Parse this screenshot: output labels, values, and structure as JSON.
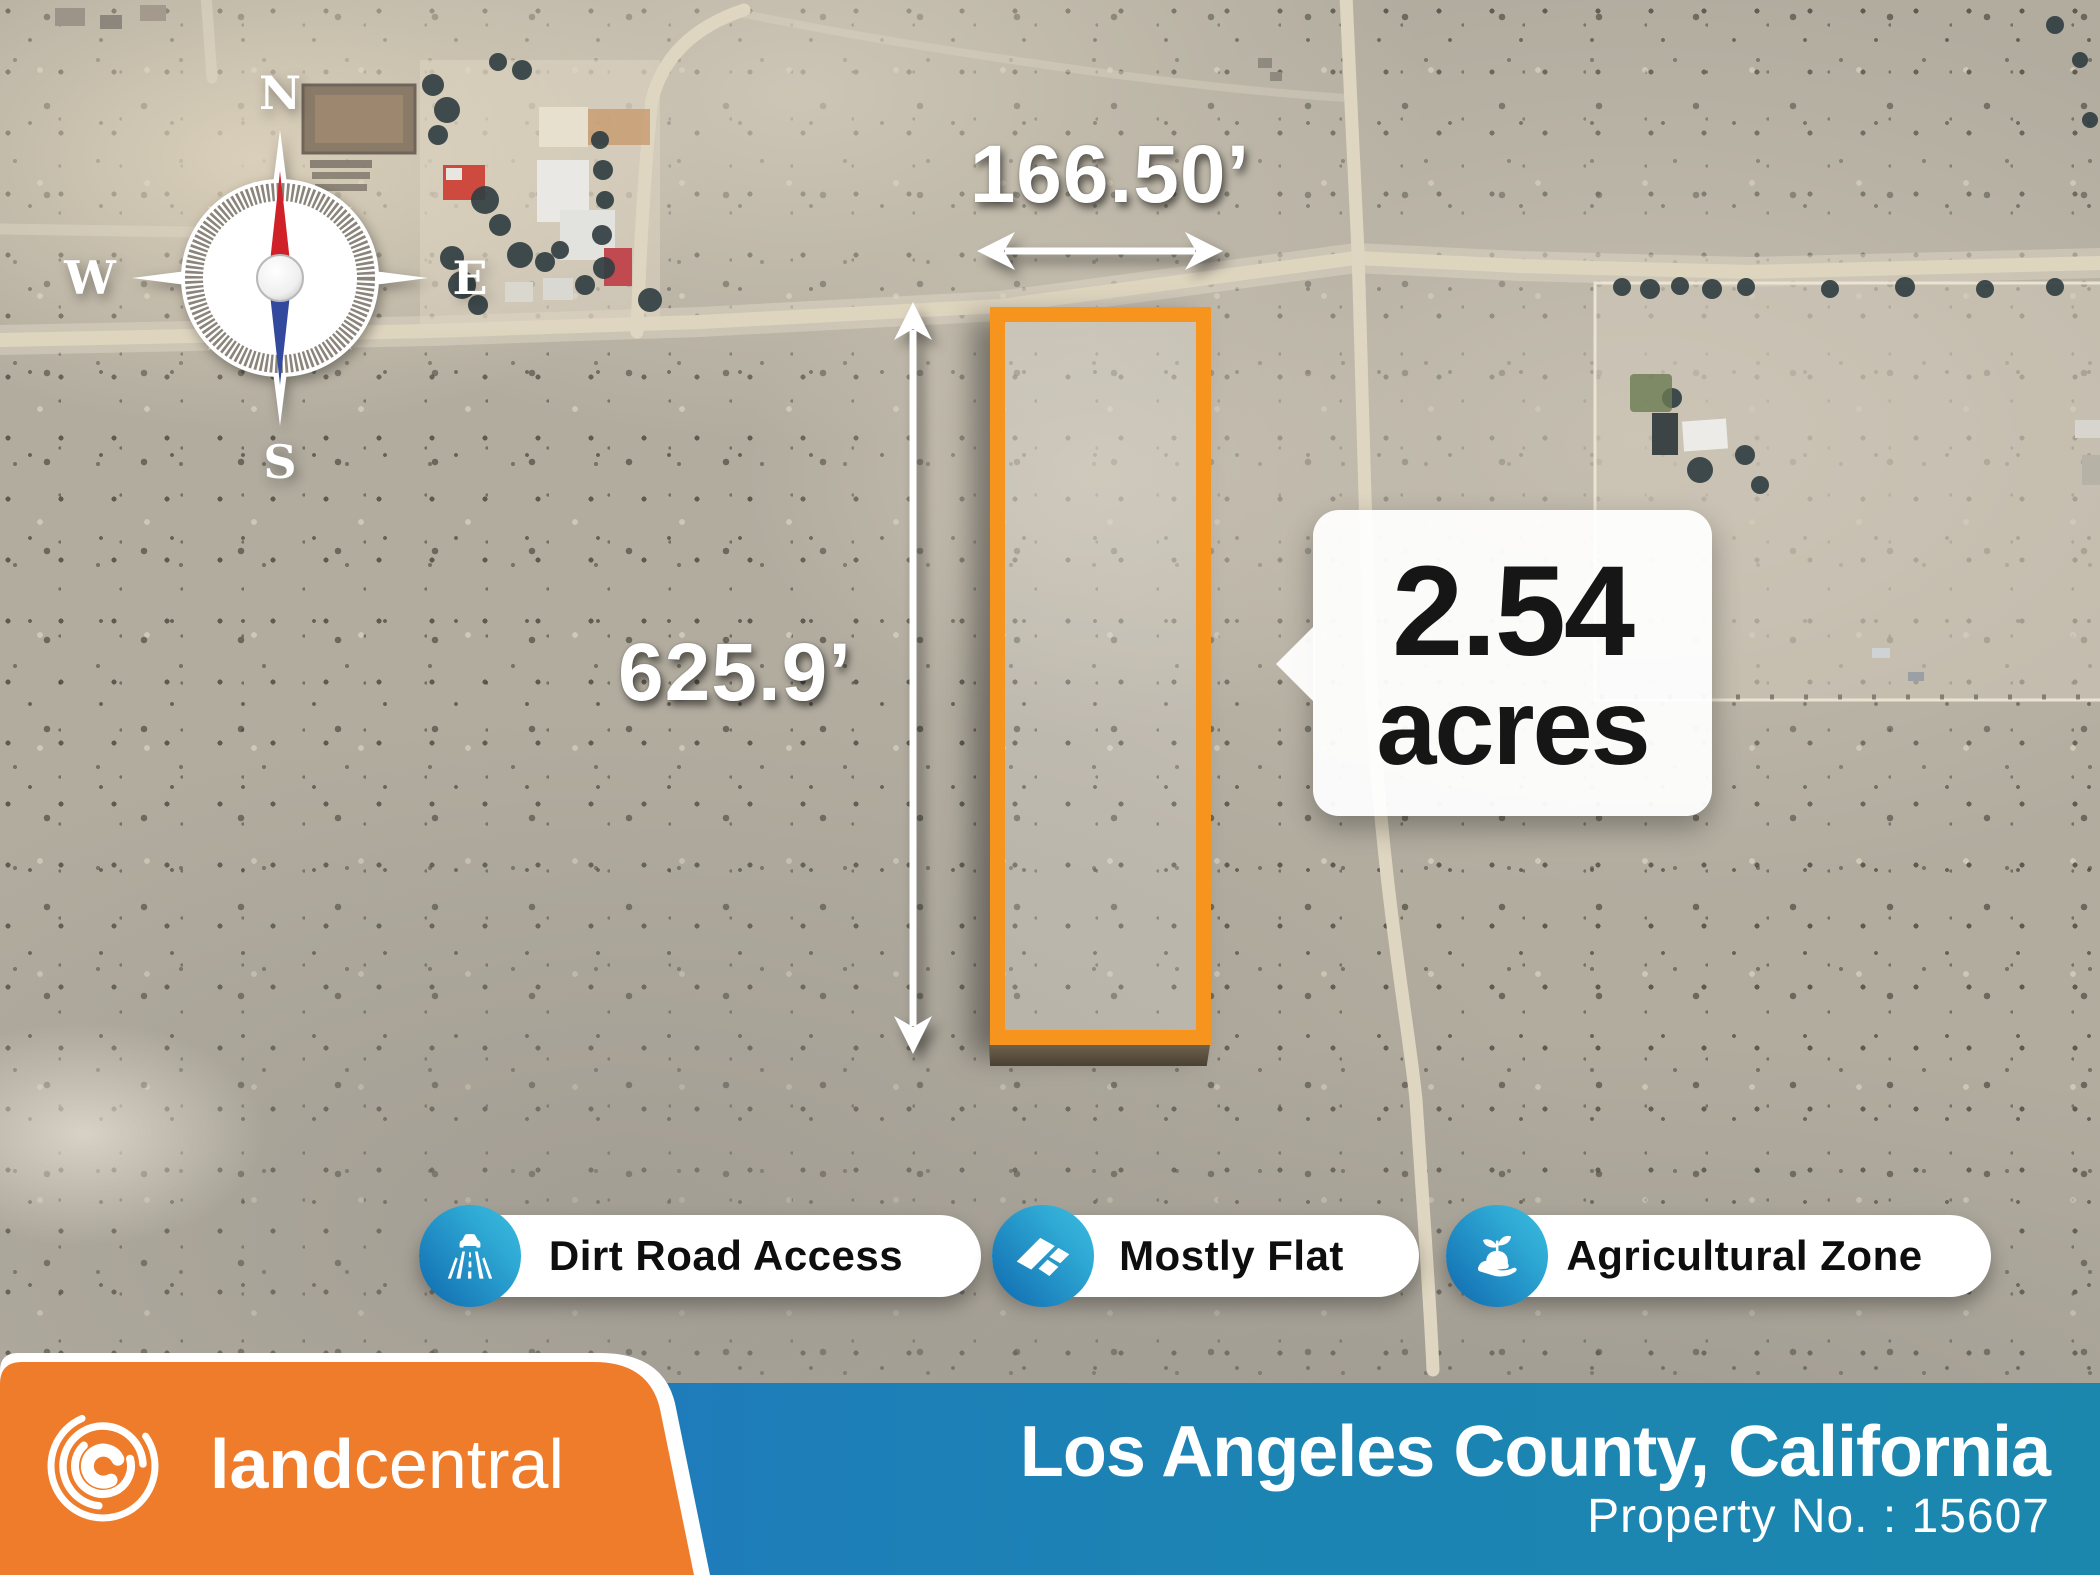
{
  "compass": {
    "north": "N",
    "east": "E",
    "south": "S",
    "west": "W"
  },
  "parcel": {
    "width_label": "166.50’",
    "height_label": "625.9’",
    "acreage_value": "2.54",
    "acreage_unit": "acres",
    "outline_color": "#f7941d"
  },
  "features": [
    {
      "label": "Dirt Road Access",
      "icon": "road-icon"
    },
    {
      "label": "Mostly Flat",
      "icon": "flat-land-icon"
    },
    {
      "label": "Agricultural Zone",
      "icon": "hand-sprout-icon"
    }
  ],
  "footer": {
    "brand_bold": "land",
    "brand_light": "central",
    "location": "Los Angeles County, California",
    "property_number": "Property No. : 15607",
    "orange": "#ee7c2b",
    "blue_start": "#2173c2",
    "blue_end": "#1b87ad",
    "badge_blue_start": "#1370b3",
    "badge_blue_end": "#3cbce0"
  }
}
